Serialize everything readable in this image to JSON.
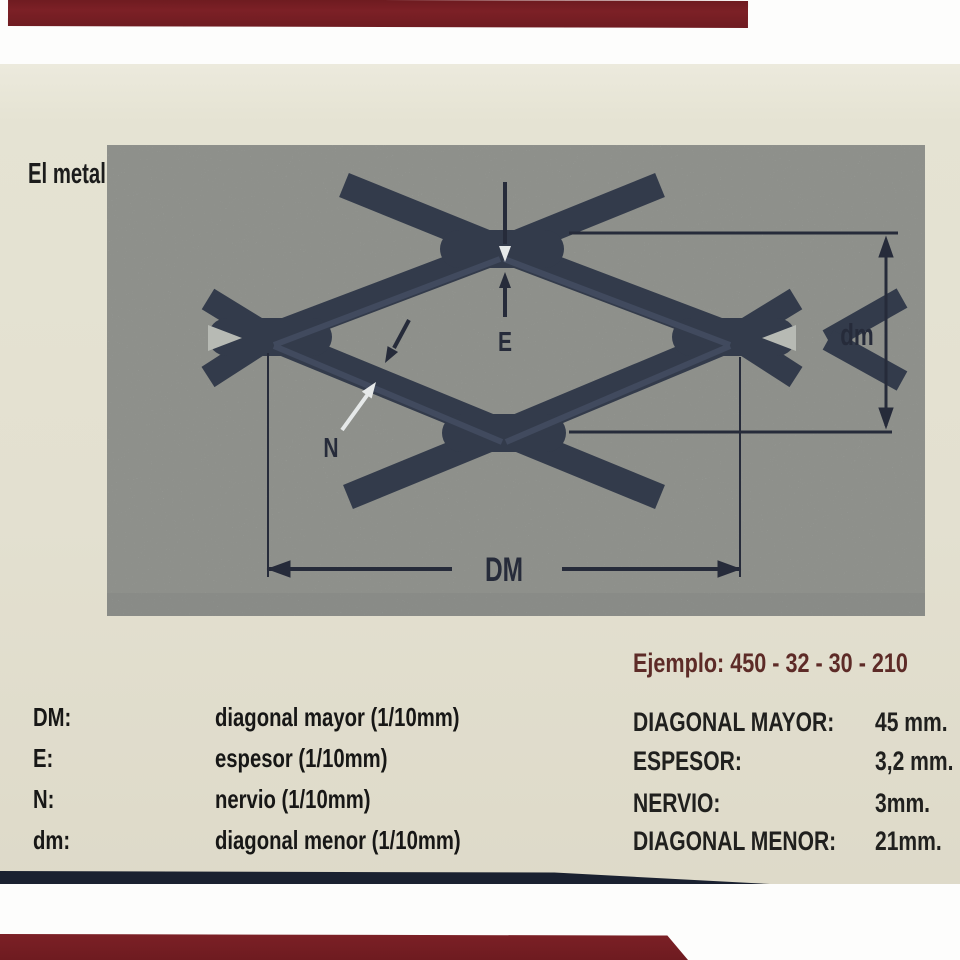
{
  "title": "El metal expandido está definido mediante un codigo que indica sus características:",
  "diagram": {
    "labels": {
      "e": "E",
      "n": "N",
      "dm_major": "DM",
      "dm_minor": "dm"
    }
  },
  "definitions": {
    "items": [
      {
        "abbr": "DM:",
        "desc": "diagonal mayor (1/10mm)"
      },
      {
        "abbr": "E:",
        "desc": "espesor (1/10mm)"
      },
      {
        "abbr": "N:",
        "desc": "nervio (1/10mm)"
      },
      {
        "abbr": "dm:",
        "desc": "diagonal menor (1/10mm)"
      }
    ]
  },
  "example": {
    "heading": "Ejemplo: 450 - 32 - 30 - 210",
    "rows": [
      {
        "label": "DIAGONAL MAYOR:",
        "value": "45 mm."
      },
      {
        "label": "ESPESOR:",
        "value": "3,2 mm."
      },
      {
        "label": "NERVIO:",
        "value": "3mm."
      },
      {
        "label": "DIAGONAL MENOR:",
        "value": "21mm."
      }
    ]
  },
  "colors": {
    "paper": "#e4e1d1",
    "panel_gray": "#b7bab4",
    "mesh_dark": "#333b4b",
    "ink": "#1b1b1b",
    "maroon_accent": "#5d2b27",
    "red_binding_bar": "#7c2026",
    "navy_paper_edge": "#1a2130"
  }
}
